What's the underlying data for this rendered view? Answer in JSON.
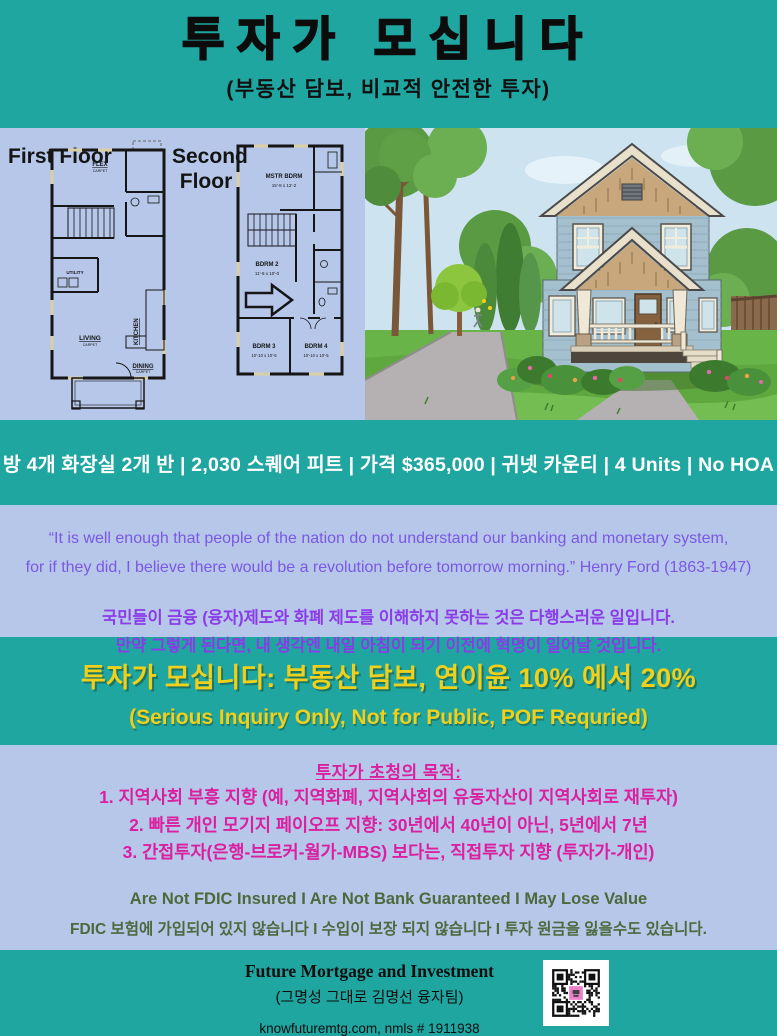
{
  "header": {
    "title": "투자가 모십니다",
    "subtitle": "(부동산 담보, 비교적 안전한 투자)"
  },
  "floorplans": {
    "first": {
      "label": "First Floor",
      "rooms": [
        "FLEX",
        "UTILITY",
        "KITCHEN",
        "LIVING",
        "DINING"
      ],
      "carpet": "CARPET"
    },
    "second": {
      "label": "Second Floor",
      "rooms": [
        {
          "name": "MSTR BDRM",
          "dims": "15'-8 x 12'-2"
        },
        {
          "name": "BDRM 2",
          "dims": "11'-8 x 10'-0"
        },
        {
          "name": "BDRM 3",
          "dims": "10'-10 x 10'-5"
        },
        {
          "name": "BDRM 4",
          "dims": "10'-10 x 10'-5"
        }
      ]
    }
  },
  "info_bar": {
    "text": "방 4개  화장실 2개 반  |  2,030 스퀘어 피트  |  가격 $365,000  |  귀넷 카운티  |  4 Units  |  No HOA"
  },
  "quote": {
    "english_line1": "“It is well enough that people of the nation do not understand our banking and monetary system,",
    "english_line2": "for if they did, I believe there would be a revolution before tomorrow morning.” Henry Ford (1863-1947)",
    "korean_line1": "국민들이 금융 (융자)제도와 화폐 제도를 이해하지 못하는 것은 다행스러운 일입니다.",
    "korean_line2": "만약 그렇게 된다면, 내 생각엔 내일 아침이 되기 이전에 혁명이 일어날 것입니다."
  },
  "offer": {
    "headline": "투자가 모십니다: 부동산 담보, 연이윤 10% 에서 20%",
    "subheadline": "(Serious Inquiry Only, Not for Public, POF Requried)"
  },
  "purpose": {
    "heading": "투자가 초청의 목적:",
    "items": [
      "1. 지역사회 부흥 지향 (예, 지역화폐, 지역사회의 유동자산이 지역사회로 재투자)",
      "2. 빠른 개인 모기지 페이오프 지향: 30년에서 40년이 아닌, 5년에서 7년",
      "3. 간접투자(은행-브로커-월가-MBS) 보다는, 직접투자 지향 (투자가-개인)"
    ]
  },
  "disclaimer": {
    "english": "Are Not FDIC Insured I Are Not Bank Guaranteed I May Lose Value",
    "korean": "FDIC 보험에 가입되어 있지 않습니다 I 수입이 보장 되지 않습니다 I 투자 원금을 잃을수도 있습니다."
  },
  "footer": {
    "company": "Future Mortgage and Investment",
    "team": "(그명성 그대로 김명선 융자팀)",
    "contact": "knowfuturemtg.com, nmls # 1911938"
  },
  "colors": {
    "teal": "#1fa6a1",
    "panel_lavender": "#b6c7ea",
    "quote_purple_english": "#7b57e4",
    "quote_purple_korean": "#8b3be8",
    "highlight_yellow": "#f0d01a",
    "magenta": "#da1f9f",
    "disclaimer_green": "#4a6a3c",
    "qr_pink": "#ea7fca"
  }
}
